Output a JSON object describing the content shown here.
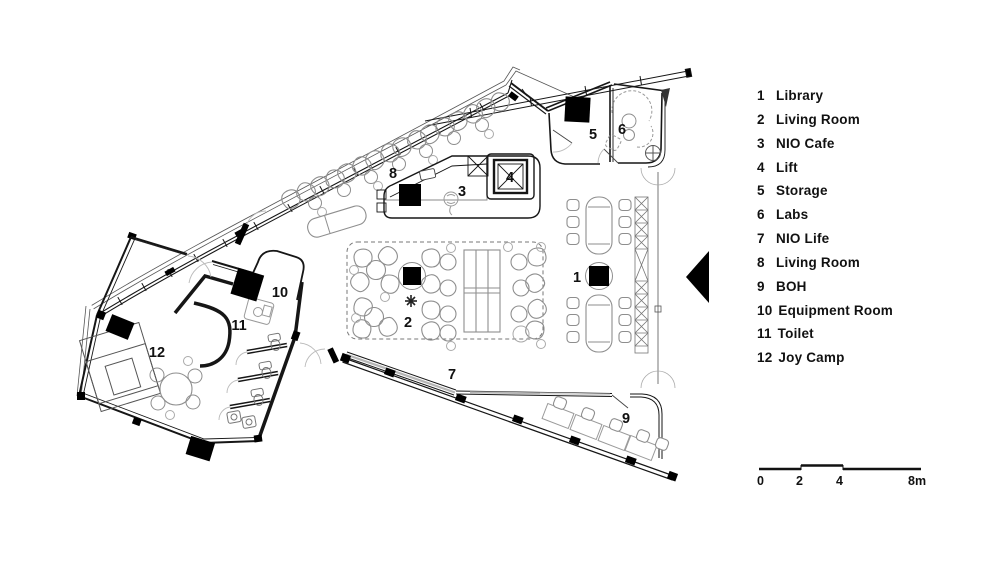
{
  "legend": {
    "items": [
      {
        "num": "1",
        "label": "Library"
      },
      {
        "num": "2",
        "label": "Living Room"
      },
      {
        "num": "3",
        "label": "NIO Cafe"
      },
      {
        "num": "4",
        "label": "Lift"
      },
      {
        "num": "5",
        "label": "Storage"
      },
      {
        "num": "6",
        "label": "Labs"
      },
      {
        "num": "7",
        "label": "NIO Life"
      },
      {
        "num": "8",
        "label": "Living Room"
      },
      {
        "num": "9",
        "label": "BOH"
      },
      {
        "num": "10",
        "label": "Equipment Room"
      },
      {
        "num": "11",
        "label": "Toilet"
      },
      {
        "num": "12",
        "label": "Joy Camp"
      }
    ]
  },
  "plan": {
    "room_numbers": {
      "r1": "1",
      "r2": "2",
      "r3": "3",
      "r4": "4",
      "r5": "5",
      "r6": "6",
      "r7": "7",
      "r8": "8",
      "r9": "9",
      "r10": "10",
      "r11": "11",
      "r12": "12"
    }
  },
  "scale_bar": {
    "ticks": [
      "0",
      "2",
      "4",
      "8m"
    ]
  },
  "colors": {
    "wall": "#161616",
    "furniture": "#8e8e8e",
    "accent_fill": "#000000"
  }
}
